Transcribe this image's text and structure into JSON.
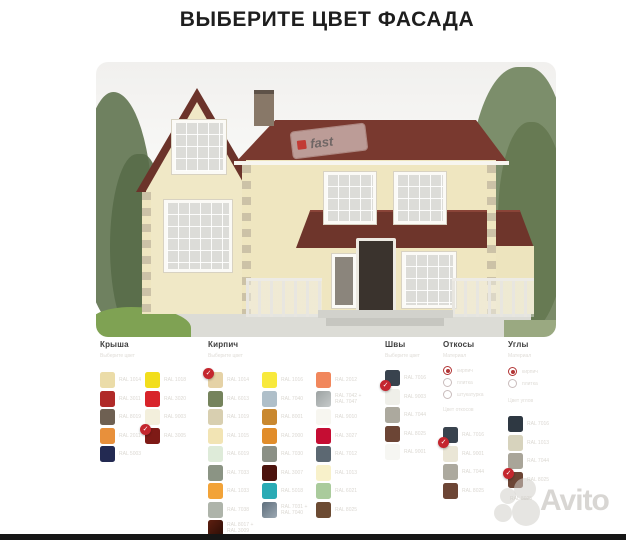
{
  "title": "ВЫБЕРИТЕ ЦВЕТ ФАСАДА",
  "watermark": {
    "house_logo_text": "fast",
    "brand": "Avito"
  },
  "palette": {
    "check_color": "#C4262E",
    "radio_color": "#B23535",
    "columns": [
      {
        "id": "krysha",
        "label": "Крыша",
        "x": 100,
        "subtitle": "Выберите цвет",
        "swatch_y0": 372,
        "groups": [
          {
            "x": 100,
            "swatches": [
              {
                "c": "#EBDCA8",
                "code": "RAL 1014"
              },
              {
                "c": "#B02A28",
                "code": "RAL 3011"
              },
              {
                "c": "#6E6052",
                "code": "RAL 8019"
              },
              {
                "c": "#E8903B",
                "code": "RAL 2011"
              },
              {
                "c": "#232A52",
                "code": "RAL 5003"
              }
            ]
          },
          {
            "x": 145,
            "swatches": [
              {
                "c": "#F2DE1C",
                "code": "RAL 1018"
              },
              {
                "c": "#D8242A",
                "code": "RAL 3020"
              },
              {
                "c": "#F3EFDC",
                "code": "RAL 9003"
              },
              {
                "c": "#7E1A16",
                "code": "RAL 3005",
                "selected": true,
                "badge": "tl"
              }
            ]
          }
        ]
      },
      {
        "id": "kirpich",
        "label": "Кирпич",
        "x": 208,
        "subtitle": "Выберите цвет",
        "swatch_y0": 372,
        "groups": [
          {
            "x": 208,
            "swatches": [
              {
                "c": "#E5D2A6",
                "code": "RAL 1014",
                "selected": true,
                "badge": "tl"
              },
              {
                "c": "#75835C",
                "code": "RAL 6013"
              },
              {
                "c": "#D8CFB0",
                "code": "RAL 1019"
              },
              {
                "c": "#F2E4B4",
                "code": "RAL 1015"
              },
              {
                "c": "#DEEBD9",
                "code": "RAL 6019"
              },
              {
                "c": "#8B9484",
                "code": "RAL 7033"
              },
              {
                "c": "#F2A338",
                "code": "RAL 1033"
              },
              {
                "c": "#AEB4AA",
                "code": "RAL 7038"
              },
              {
                "c": "#5E1F10",
                "c2": "#2B0D05",
                "code": "RAL 8017 +",
                "code2": "RAL 3009"
              }
            ]
          },
          {
            "x": 262,
            "swatches": [
              {
                "c": "#F8E93C",
                "code": "RAL 1016"
              },
              {
                "c": "#AFBFC9",
                "code": "RAL 7040"
              },
              {
                "c": "#C9882F",
                "code": "RAL 8001"
              },
              {
                "c": "#E18D2B",
                "code": "RAL 2000"
              },
              {
                "c": "#8B9086",
                "code": "RAL 7030"
              },
              {
                "c": "#4C130D",
                "code": "RAL 3007"
              },
              {
                "c": "#2AABB5",
                "code": "RAL 5018"
              },
              {
                "c": "#5E6E7C",
                "c2": "#9CA8B2",
                "code": "RAL 7031 +",
                "code2": "RAL 7040"
              }
            ]
          },
          {
            "x": 316,
            "swatches": [
              {
                "c": "#F1875C",
                "code": "RAL 2012"
              },
              {
                "c": "#9CA2A2",
                "c2": "#C6CACA",
                "code": "RAL 7042 +",
                "code2": "RAL 7047"
              },
              {
                "c": "#F7F6F0",
                "code": "RAL 9010"
              },
              {
                "c": "#C50D33",
                "code": "RAL 3027"
              },
              {
                "c": "#5C6872",
                "code": "RAL 7012"
              },
              {
                "c": "#F8F1CA",
                "code": "RAL 1013"
              },
              {
                "c": "#AACB9C",
                "code": "RAL 6021"
              },
              {
                "c": "#6C4B33",
                "code": "RAL 8025"
              }
            ]
          }
        ]
      },
      {
        "id": "shvy",
        "label": "Швы",
        "x": 385,
        "subtitle": "Выберите цвет",
        "swatch_y0": 370,
        "groups": [
          {
            "x": 385,
            "swatches": [
              {
                "c": "#39434E",
                "code": "RAL 7016",
                "selected": true,
                "badge": "bl"
              },
              {
                "c": "#EFEFE9",
                "code": "RAL 9003"
              },
              {
                "c": "#ACA99E",
                "code": "RAL 7044"
              },
              {
                "c": "#6C4535",
                "code": "RAL 8025"
              },
              {
                "c": "#F6F6F2",
                "code": "RAL 9001"
              }
            ]
          }
        ]
      },
      {
        "id": "otkosy",
        "label": "Откосы",
        "x": 443,
        "subtitle": "Материал",
        "radio_y0": 366,
        "section_label": "Цвет откосов",
        "section_y": 407,
        "radios": [
          {
            "label": "кирпич",
            "selected": true
          },
          {
            "label": "плитка",
            "selected": false
          },
          {
            "label": "штукатурка",
            "selected": false
          }
        ],
        "swatch_y0": 427,
        "groups": [
          {
            "x": 443,
            "swatches": [
              {
                "c": "#39434E",
                "code": "RAL 7016",
                "selected": true,
                "badge": "bl"
              },
              {
                "c": "#EAE6D6",
                "code": "RAL 9001"
              },
              {
                "c": "#ACA99E",
                "code": "RAL 7044"
              },
              {
                "c": "#6C4535",
                "code": "RAL 8025"
              }
            ]
          }
        ]
      },
      {
        "id": "ugly",
        "label": "Углы",
        "x": 508,
        "subtitle": "Материал",
        "radio_y0": 367,
        "section_label": "Цвет углов",
        "section_y": 398,
        "radios": [
          {
            "label": "кирпич",
            "selected": true
          },
          {
            "label": "плитка",
            "selected": false
          }
        ],
        "swatch_y0": 416,
        "footer_label": "RAL 8025",
        "footer_y": 496,
        "groups": [
          {
            "x": 508,
            "swatches": [
              {
                "c": "#2E3842",
                "code": "RAL 7016"
              },
              {
                "c": "#D7D3BD",
                "code": "RAL 1013"
              },
              {
                "c": "#A9A599",
                "code": "RAL 7044"
              },
              {
                "c": "#6C4535",
                "code": "RAL 8025",
                "selected": true,
                "badge": "tl"
              }
            ]
          }
        ]
      }
    ]
  }
}
